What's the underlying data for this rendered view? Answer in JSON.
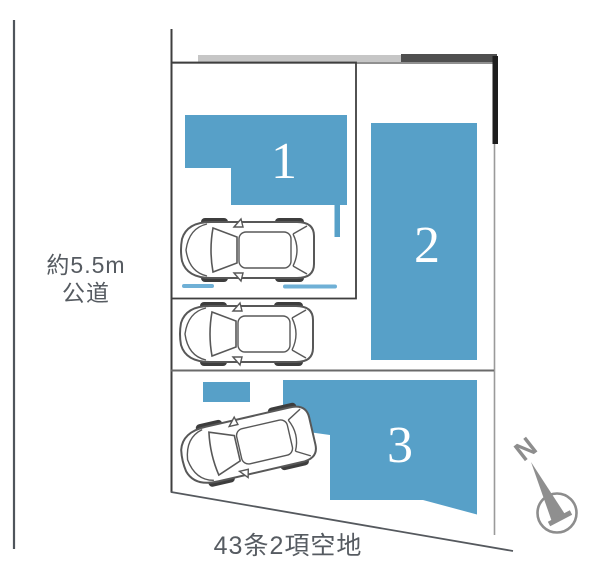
{
  "diagram": {
    "road_label": {
      "line1": "約5.5m",
      "line2": "公道"
    },
    "bottom_label": "43条2項空地",
    "lots": [
      {
        "number": "1"
      },
      {
        "number": "2"
      },
      {
        "number": "3"
      }
    ],
    "compass": {
      "north_label": "N"
    },
    "cars_count": 3
  },
  "colors": {
    "lot_fill": "#57a0c8",
    "dash": "#6fb0d6",
    "text": "#565b61",
    "lot_number_text": "#ffffff",
    "compass_gray": "#8d8d8d"
  }
}
